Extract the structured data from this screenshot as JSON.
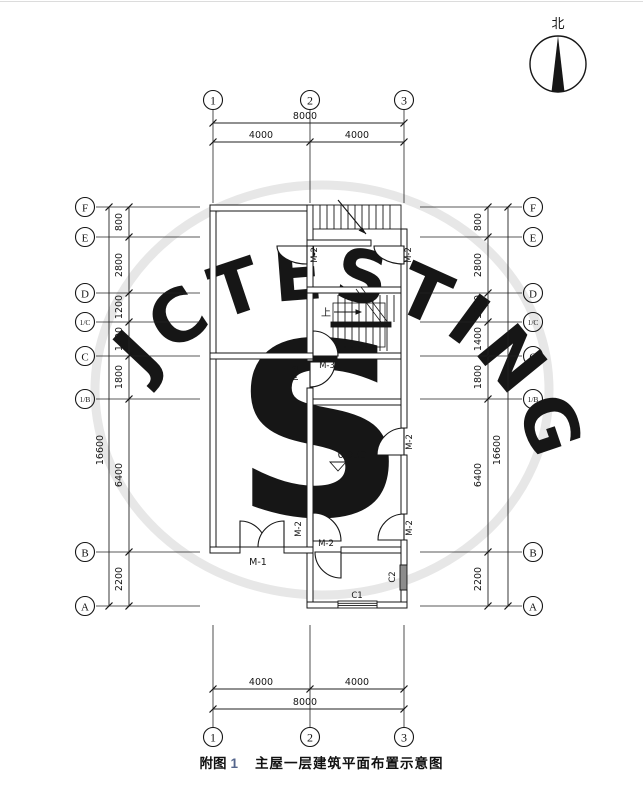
{
  "north": {
    "label": "北"
  },
  "watermark": {
    "text": "JCTESTING",
    "glyph": "S"
  },
  "caption": {
    "prefix": "附图",
    "number": "1",
    "title": "主屋一层建筑平面布置示意图"
  },
  "axes": {
    "cols": [
      {
        "label": "1"
      },
      {
        "label": "2"
      },
      {
        "label": "3"
      }
    ],
    "rows": [
      {
        "label": "F"
      },
      {
        "label": "E"
      },
      {
        "label": "D"
      },
      {
        "label": "1/C"
      },
      {
        "label": "C"
      },
      {
        "label": "1/B"
      },
      {
        "label": "B"
      },
      {
        "label": "A"
      }
    ]
  },
  "dims": {
    "top": {
      "overall": "8000",
      "segments": [
        "4000",
        "4000"
      ]
    },
    "bottom": {
      "overall": "8000",
      "segments": [
        "4000",
        "4000"
      ]
    },
    "left": {
      "overall": "16600",
      "segments": [
        "800",
        "2800",
        "1200",
        "1400",
        "1800",
        "6400",
        "2200"
      ]
    },
    "right": {
      "overall": "16600",
      "segments": [
        "800",
        "2800",
        "1200",
        "1400",
        "1800",
        "6400",
        "2200"
      ]
    }
  },
  "plan": {
    "doors": {
      "m1": "M-1",
      "m2": "M-2",
      "m3": "M-3"
    },
    "windows": {
      "c1": "C1",
      "c2": "C2"
    },
    "level": "0.350",
    "stair_up": "上"
  }
}
